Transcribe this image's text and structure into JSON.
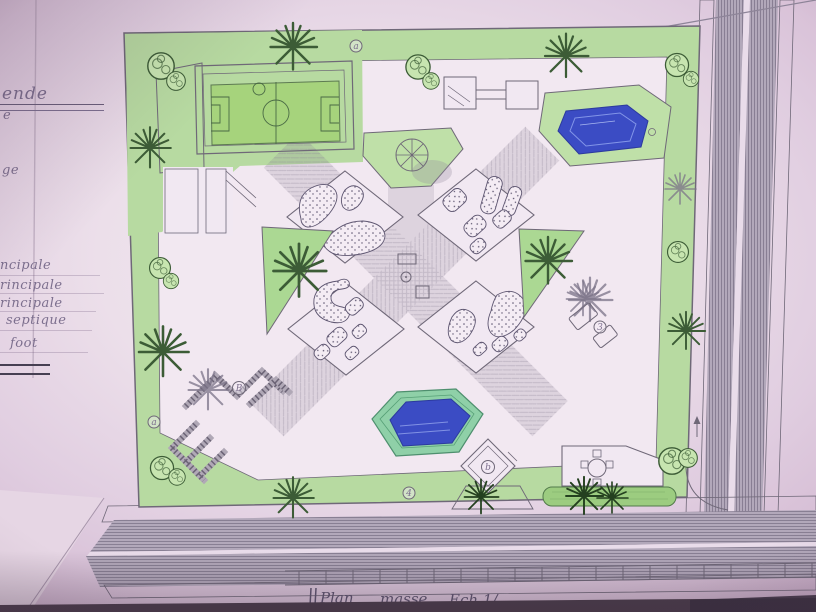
{
  "legend": {
    "title_fragment": "ende",
    "items": [
      "e",
      "ge",
      "ncipale",
      "rincipale",
      "rincipale",
      "septique",
      "foot"
    ]
  },
  "caption": {
    "words": [
      "Plan",
      "masse",
      "Ech 1/"
    ]
  },
  "plan_labels": {
    "top_band": "a",
    "left_band": "a",
    "pavilion_sw": "B",
    "kiosk": "b",
    "bench_east": "3",
    "south_path": "4"
  },
  "colors": {
    "paper_center": "#f3e9f2",
    "paper_edge": "#c9aac6",
    "park_fill": "#f2e8f1",
    "green_band": "#b7daa1",
    "green_bright": "#bfe0a8",
    "field_green": "#a6d37c",
    "pool_water": "#3b4cc4",
    "pool_rim": "#8fd0a8",
    "hedge_green": "#9ccc80",
    "dark_green": "#3c5c36",
    "tree_fill": "#c7e5b0",
    "ink": "#6f6878",
    "pencil": "#8d8498",
    "text_pencil": "#7c6f8e",
    "road_base": "#b2a8ba",
    "photo_shadow": "#4b3d4b"
  }
}
